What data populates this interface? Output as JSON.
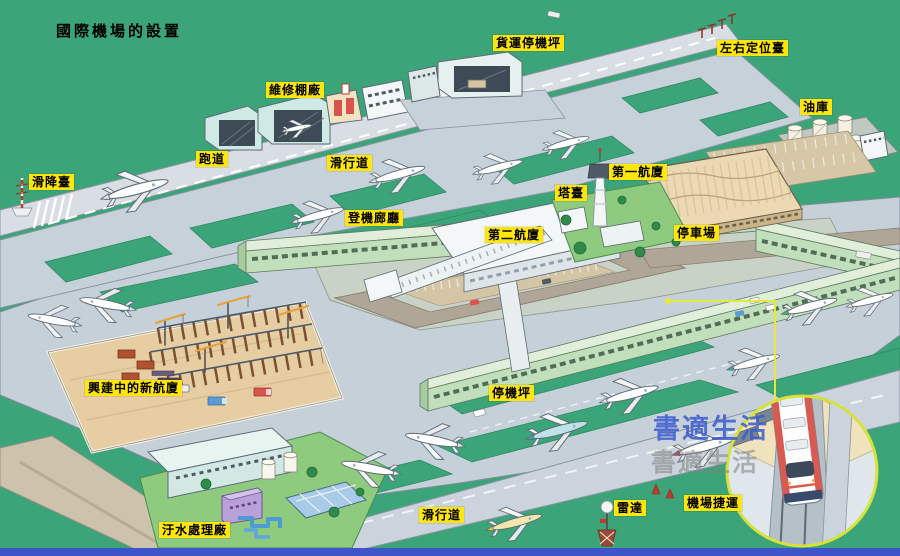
{
  "title": "國際機場的設置",
  "labels": {
    "maintenance_hangar": "維修棚廠",
    "cargo_apron": "貨運停機坪",
    "localizer": "左右定位臺",
    "fuel_depot": "油庫",
    "runway": "跑道",
    "taxiway_top": "滑行道",
    "glide_slope": "滑降臺",
    "terminal_1": "第一航廈",
    "control_tower": "塔臺",
    "boarding_corridor": "登機廊廳",
    "terminal_2": "第二航廈",
    "parking_lot": "停車場",
    "new_terminal_under_construction": "興建中的新航廈",
    "apron": "停機坪",
    "sewage_plant": "汙水處理廠",
    "taxiway_bottom": "滑行道",
    "radar": "雷達",
    "airport_mrt": "機場捷運"
  },
  "watermark": {
    "line1": "書適生活",
    "line2": "書適生活"
  },
  "colors": {
    "background_green": "#3BA478",
    "label_yellow": "#FFE60A",
    "tarmac_gray": "#C7D1DA",
    "runway_gray": "#D8DEE3",
    "road_taupe": "#AFA698",
    "concourse_green": "#C2DFBB",
    "terminal_roof_tan": "#ECD8B2",
    "callout_yellow": "#E8E838",
    "bottom_strip_blue": "#3D55C8",
    "watermark_blue": "#3A5CCD"
  }
}
